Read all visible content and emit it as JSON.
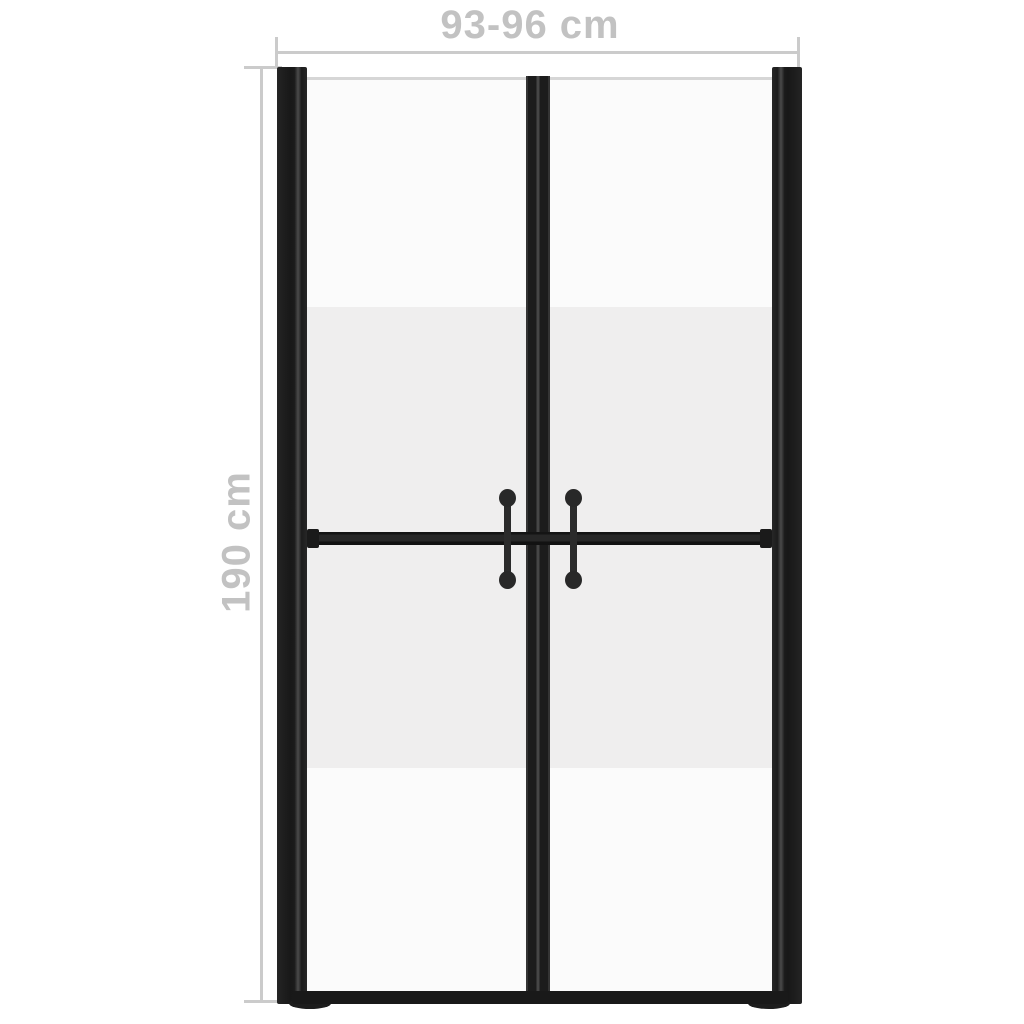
{
  "page": {
    "background": "#ffffff"
  },
  "product": {
    "subject": "double-swing shower door with half-frosted safety glass and black frame",
    "parts": [
      "left-frame-post",
      "right-frame-post",
      "glass-panel",
      "frosted-glass-band",
      "center-door-stiles",
      "crossbar",
      "bottom-rail",
      "left-door-handle",
      "right-door-handle"
    ]
  },
  "dimensions": {
    "width_label": "93-96 cm",
    "height_label": "190 cm"
  },
  "colors": {
    "frame": "#1c1c1c",
    "frame_highlight": "#4a4a4a",
    "glass_clear": "#fbfbfb",
    "glass_frosted": "#efeeee",
    "glass_top_edge": "#d6d6d6",
    "handle": "#2b2b2b",
    "dimension_line": "#cbcbcb",
    "dimension_text": "#c2c2c2",
    "background": "#ffffff"
  }
}
